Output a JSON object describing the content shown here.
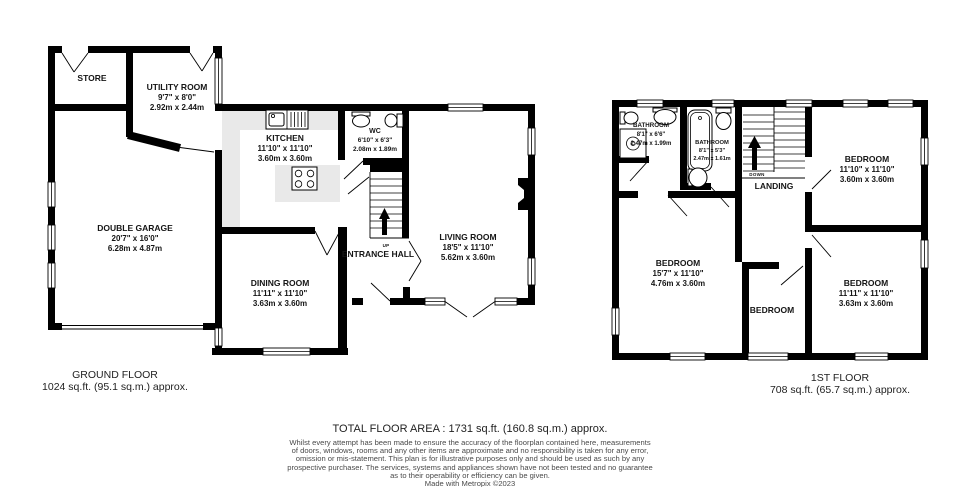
{
  "colors": {
    "wall": "#000000",
    "counter": "#e9e9e9",
    "text": "#151515"
  },
  "ground_floor": {
    "title": "GROUND FLOOR",
    "area": "1024 sq.ft. (95.1 sq.m.) approx.",
    "stairs_label": "UP",
    "rooms": {
      "store": {
        "name": "STORE"
      },
      "utility": {
        "name": "UTILITY ROOM",
        "dims_ft": "9'7\" x 8'0\"",
        "dims_m": "2.92m x 2.44m"
      },
      "kitchen": {
        "name": "KITCHEN",
        "dims_ft": "11'10\" x 11'10\"",
        "dims_m": "3.60m x 3.60m"
      },
      "wc": {
        "name": "WC",
        "dims_ft": "6'10\" x 6'3\"",
        "dims_m": "2.08m x 1.89m"
      },
      "garage": {
        "name": "DOUBLE GARAGE",
        "dims_ft": "20'7\" x 16'0\"",
        "dims_m": "6.28m x 4.87m"
      },
      "dining": {
        "name": "DINING ROOM",
        "dims_ft": "11'11\" x 11'10\"",
        "dims_m": "3.63m x 3.60m"
      },
      "entrance": {
        "name": "ENTRANCE HALL"
      },
      "living": {
        "name": "LIVING ROOM",
        "dims_ft": "18'5\" x 11'10\"",
        "dims_m": "5.62m x 3.60m"
      }
    }
  },
  "first_floor": {
    "title": "1ST FLOOR",
    "area": "708 sq.ft. (65.7 sq.m.) approx.",
    "stairs_label": "DOWN",
    "rooms": {
      "bathroom1": {
        "name": "BATHROOM",
        "dims_ft": "8'1\" x 6'6\"",
        "dims_m": "2.47m x 1.99m"
      },
      "bathroom2": {
        "name": "BATHROOM",
        "dims_ft": "8'1\" x 5'3\"",
        "dims_m": "2.47m x 1.61m"
      },
      "landing": {
        "name": "LANDING"
      },
      "bedroom_top_right": {
        "name": "BEDROOM",
        "dims_ft": "11'10\" x 11'10\"",
        "dims_m": "3.60m x 3.60m"
      },
      "bedroom_left": {
        "name": "BEDROOM",
        "dims_ft": "15'7\" x 11'10\"",
        "dims_m": "4.76m x 3.60m"
      },
      "bedroom_middle": {
        "name": "BEDROOM"
      },
      "bedroom_bottom_right": {
        "name": "BEDROOM",
        "dims_ft": "11'11\" x 11'10\"",
        "dims_m": "3.63m x 3.60m"
      }
    }
  },
  "footer": {
    "total_area": "TOTAL FLOOR AREA : 1731 sq.ft. (160.8 sq.m.) approx.",
    "disclaimer_lines": [
      "Whilst every attempt has been made to ensure the accuracy of the floorplan contained here, measurements",
      "of doors, windows, rooms and any other items are approximate and no responsibility is taken for any error,",
      "omission or mis-statement. This plan is for illustrative purposes only and should be used as such by any",
      "prospective purchaser. The services, systems and appliances shown have not been tested and no guarantee",
      "as to their operability or efficiency can be given.",
      "Made with Metropix ©2023"
    ]
  }
}
